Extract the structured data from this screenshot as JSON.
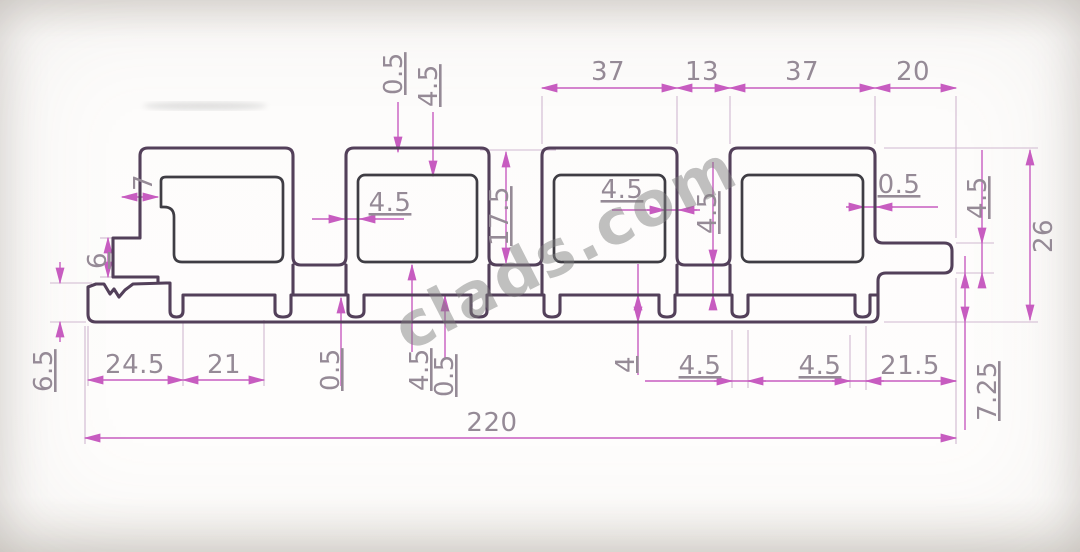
{
  "drawing": {
    "watermark": "clads.com",
    "colors": {
      "profile_outline": "#53405a",
      "chamber_outline": "#3f3d44",
      "dimension_lines": "#c75cc0",
      "extension_lines": "#d0b8d0",
      "dimension_text": "#958a96"
    },
    "dimensions": {
      "top": {
        "w37_left": "37",
        "w13": "13",
        "w37_right": "37",
        "w20": "20"
      },
      "upper": {
        "skin": "0.5",
        "top_wall": "4.5",
        "channel_depth": "17.5",
        "box2_wall": "4.5",
        "box3_wall": "4.5",
        "ch3_web": "4.5",
        "box4_wall": "0.5"
      },
      "right": {
        "tongue_thickness": "4.5",
        "total_height": "26",
        "lip": "7.25"
      },
      "left": {
        "hook_step": "7",
        "notch": "6",
        "flange": "6.5"
      },
      "bottom": {
        "w245": "24.5",
        "w21": "21",
        "s05a": "0.5",
        "s45a": "4.5",
        "s05b": "0.5",
        "s4": "4",
        "s45c": "4.5",
        "s45d": "4.5",
        "w215": "21.5",
        "total_width": "220"
      }
    }
  }
}
